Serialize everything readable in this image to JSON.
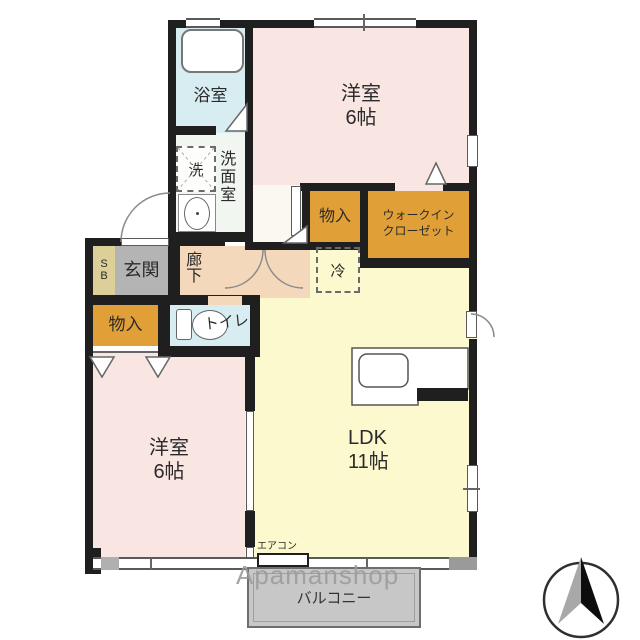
{
  "colors": {
    "wall": "#1f1f1f",
    "bedroom": "#f9e6e3",
    "bathroom": "#d7edf1",
    "toilet": "#d7edf1",
    "washroom": "#f2f6f1",
    "corridor": "#f3d8bc",
    "nook": "#fbf8f2",
    "entrance": "#b4b4b4",
    "shoebox": "#dccf97",
    "storage": "#e1a037",
    "ldk": "#fbf9cd",
    "balcony": "#c7c7c8",
    "watermark": "#9c9c9c"
  },
  "rooms": {
    "bathroom": {
      "label": "浴室"
    },
    "bedroom_top": {
      "label": "洋室",
      "size": "6帖"
    },
    "washroom": {
      "label": "洗面室"
    },
    "washer": {
      "label": "洗"
    },
    "entrance": {
      "label": "玄関"
    },
    "shoebox": {
      "line1": "S",
      "line2": "B"
    },
    "corridor": {
      "label": "廊下"
    },
    "storage_top": {
      "label": "物入"
    },
    "wic": {
      "line1": "ウォークイン",
      "line2": "クローゼット"
    },
    "fridge": {
      "label": "冷"
    },
    "storage_bottom": {
      "label": "物入"
    },
    "toilet": {
      "label": "トイレ"
    },
    "bedroom_bottom": {
      "label": "洋室",
      "size": "6帖"
    },
    "ldk": {
      "label": "LDK",
      "size": "11帖"
    },
    "aircon": {
      "label": "エアコン"
    },
    "balcony": {
      "label": "バルコニー"
    }
  },
  "watermark": {
    "text": "Apamanshop"
  }
}
